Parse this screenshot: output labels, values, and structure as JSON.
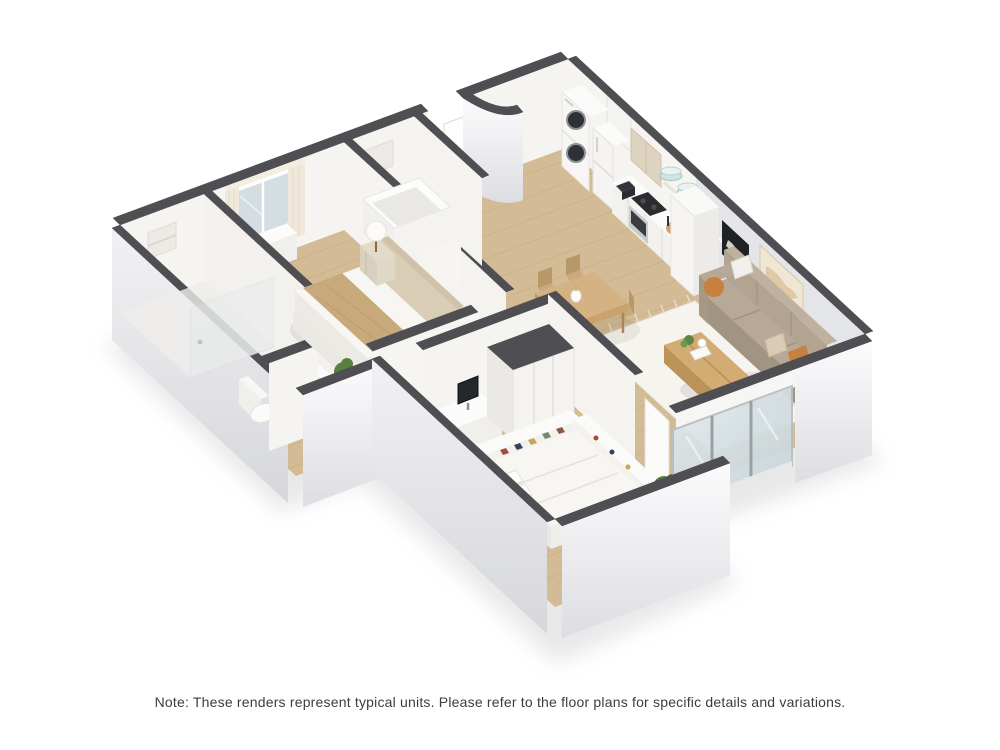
{
  "caption": {
    "text": "Note: These renders represent typical units. Please refer to the floor plans for specific details and variations."
  },
  "colors": {
    "background": "#ffffff",
    "wall_cap": "#4f4f53",
    "wall_interior": "#f6f4f1",
    "wall_interior_shaded": "#eceae6",
    "living_wall": "#e4e5e9",
    "wood_floor": "#d3bb95",
    "tile_floor": "#f2f1ee",
    "rug": "#f6f4ef",
    "sofa": "#b3a491",
    "sofa_shadow": "#a29482",
    "wood_furniture": "#d3ac73",
    "wood_furniture_side": "#bb9257",
    "dining_wood": "#d4b284",
    "bed_linen": "#f7f6f3",
    "bed_throw": "#c8a97c",
    "headboard_wood": "#d9cdb5",
    "nightstand_wood": "#e3dac7",
    "plant": "#55803f",
    "plant_light": "#6a9a4e",
    "accent_pillow": "#c8803f",
    "glass": "#d3dde2",
    "appliance_dark": "#2e3136",
    "upper_cabinet": "#ddd3c0",
    "plate_teal": "#cfe3df",
    "art_dark": "#202127",
    "art_beige": "#efe6d4",
    "art_navy": "#2c3e55",
    "caption_color": "#3d3d3f",
    "shadow": "#9a9aa0"
  }
}
